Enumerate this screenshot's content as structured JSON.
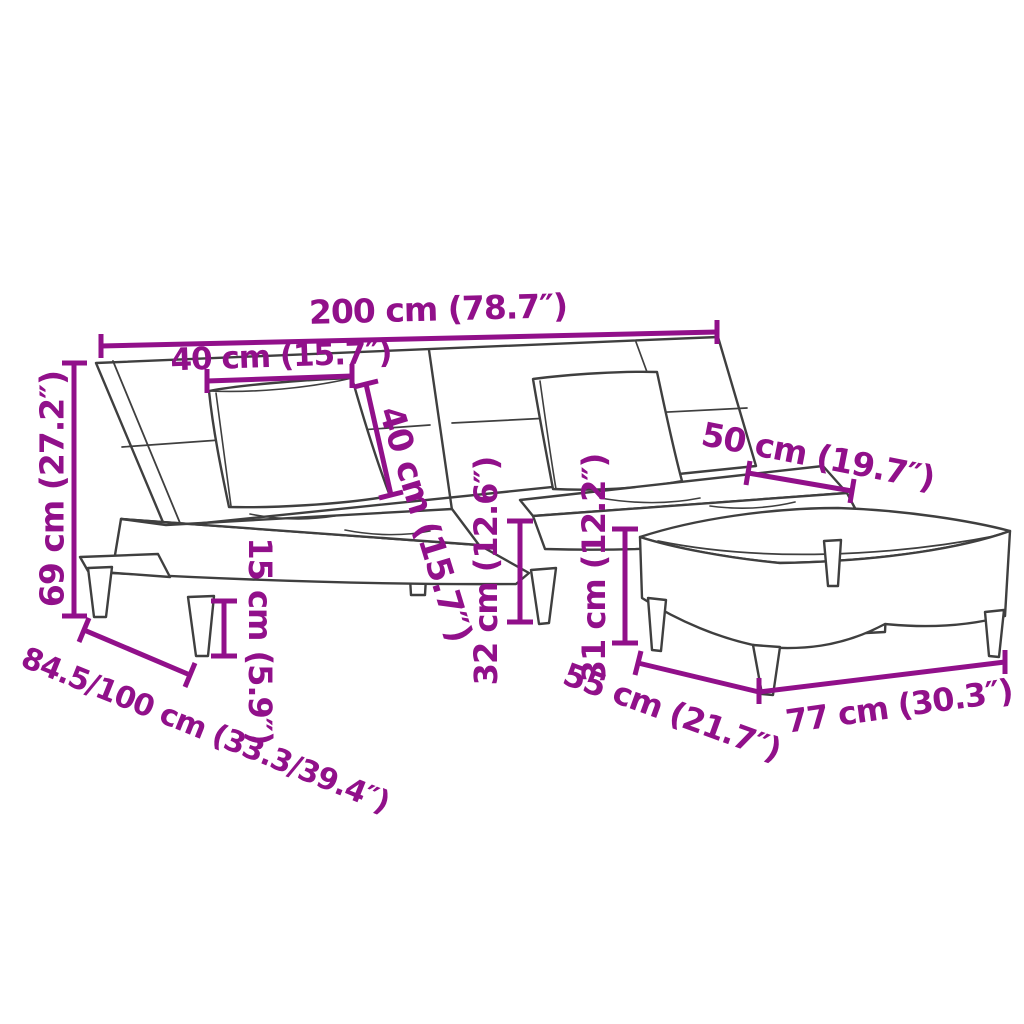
{
  "colors": {
    "dimension_annotation": "#91108a",
    "line_art": "#3f3f3f",
    "background": "#ffffff"
  },
  "dimensions": {
    "sofa_total_width": {
      "label": "200 cm (78.7″)"
    },
    "pillow_width": {
      "label": "40 cm (15.7″)"
    },
    "pillow_height": {
      "label": "40 cm (15.7″)"
    },
    "backrest_height": {
      "label": "69 cm (27.2″)"
    },
    "seat_depth": {
      "label": "50 cm (19.7″)"
    },
    "sofa_depth_range": {
      "label": "84.5/100 cm (33.3/39.4″)"
    },
    "leg_height": {
      "label": "15 cm (5.9″)"
    },
    "seat_height": {
      "label": "32 cm (12.6″)"
    },
    "footstool_height": {
      "label": "31 cm (12.2″)"
    },
    "footstool_depth": {
      "label": "55 cm (21.7″)"
    },
    "footstool_width": {
      "label": "77 cm (30.3″)"
    }
  }
}
